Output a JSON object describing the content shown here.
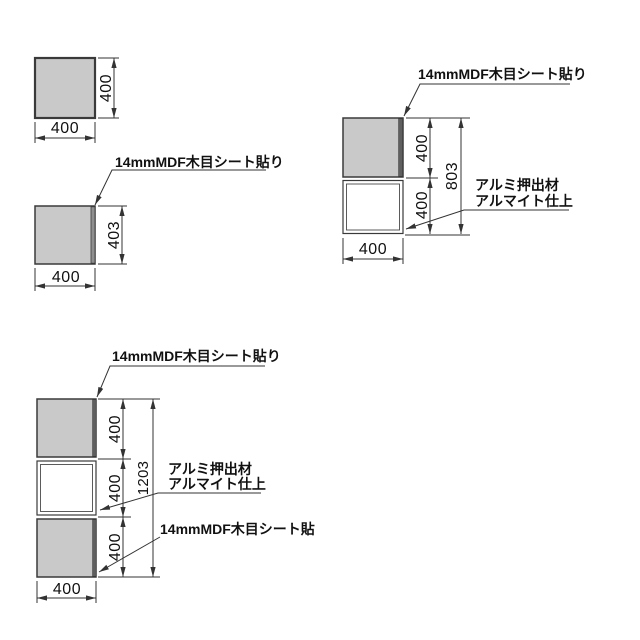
{
  "title": "panel-elevation-drawings",
  "colors": {
    "background": "#ffffff",
    "line": "#333333",
    "text": "#111111",
    "panel_fill": "#c9c9c9",
    "panel_edge": "#3a3a3a",
    "mdf_edge_strip": "#8f8f8f",
    "mdf_edge_strip_dark": "#5f5f5f"
  },
  "views": {
    "single_panel": {
      "height": "400",
      "width": "400"
    },
    "single_panel_labeled": {
      "mdf_callout": "14mmMDF木目シート貼り",
      "height": "403",
      "width": "400"
    },
    "two_tier_unit": {
      "mdf_callout": "14mmMDF木目シート貼り",
      "seg_top": "400",
      "seg_bottom": "400",
      "total": "803",
      "alumi_callout_line1": "アルミ押出材",
      "alumi_callout_line2": "アルマイト仕上",
      "width": "400"
    },
    "three_tier_unit": {
      "mdf_callout": "14mmMDF木目シート貼り",
      "seg_top": "400",
      "seg_middle": "400",
      "seg_bottom": "400",
      "total": "1203",
      "alumi_callout_line1": "アルミ押出材",
      "alumi_callout_line2": "アルマイト仕上",
      "mdf_callout_bottom": "14mmMDF木目シート貼",
      "width": "400"
    }
  }
}
